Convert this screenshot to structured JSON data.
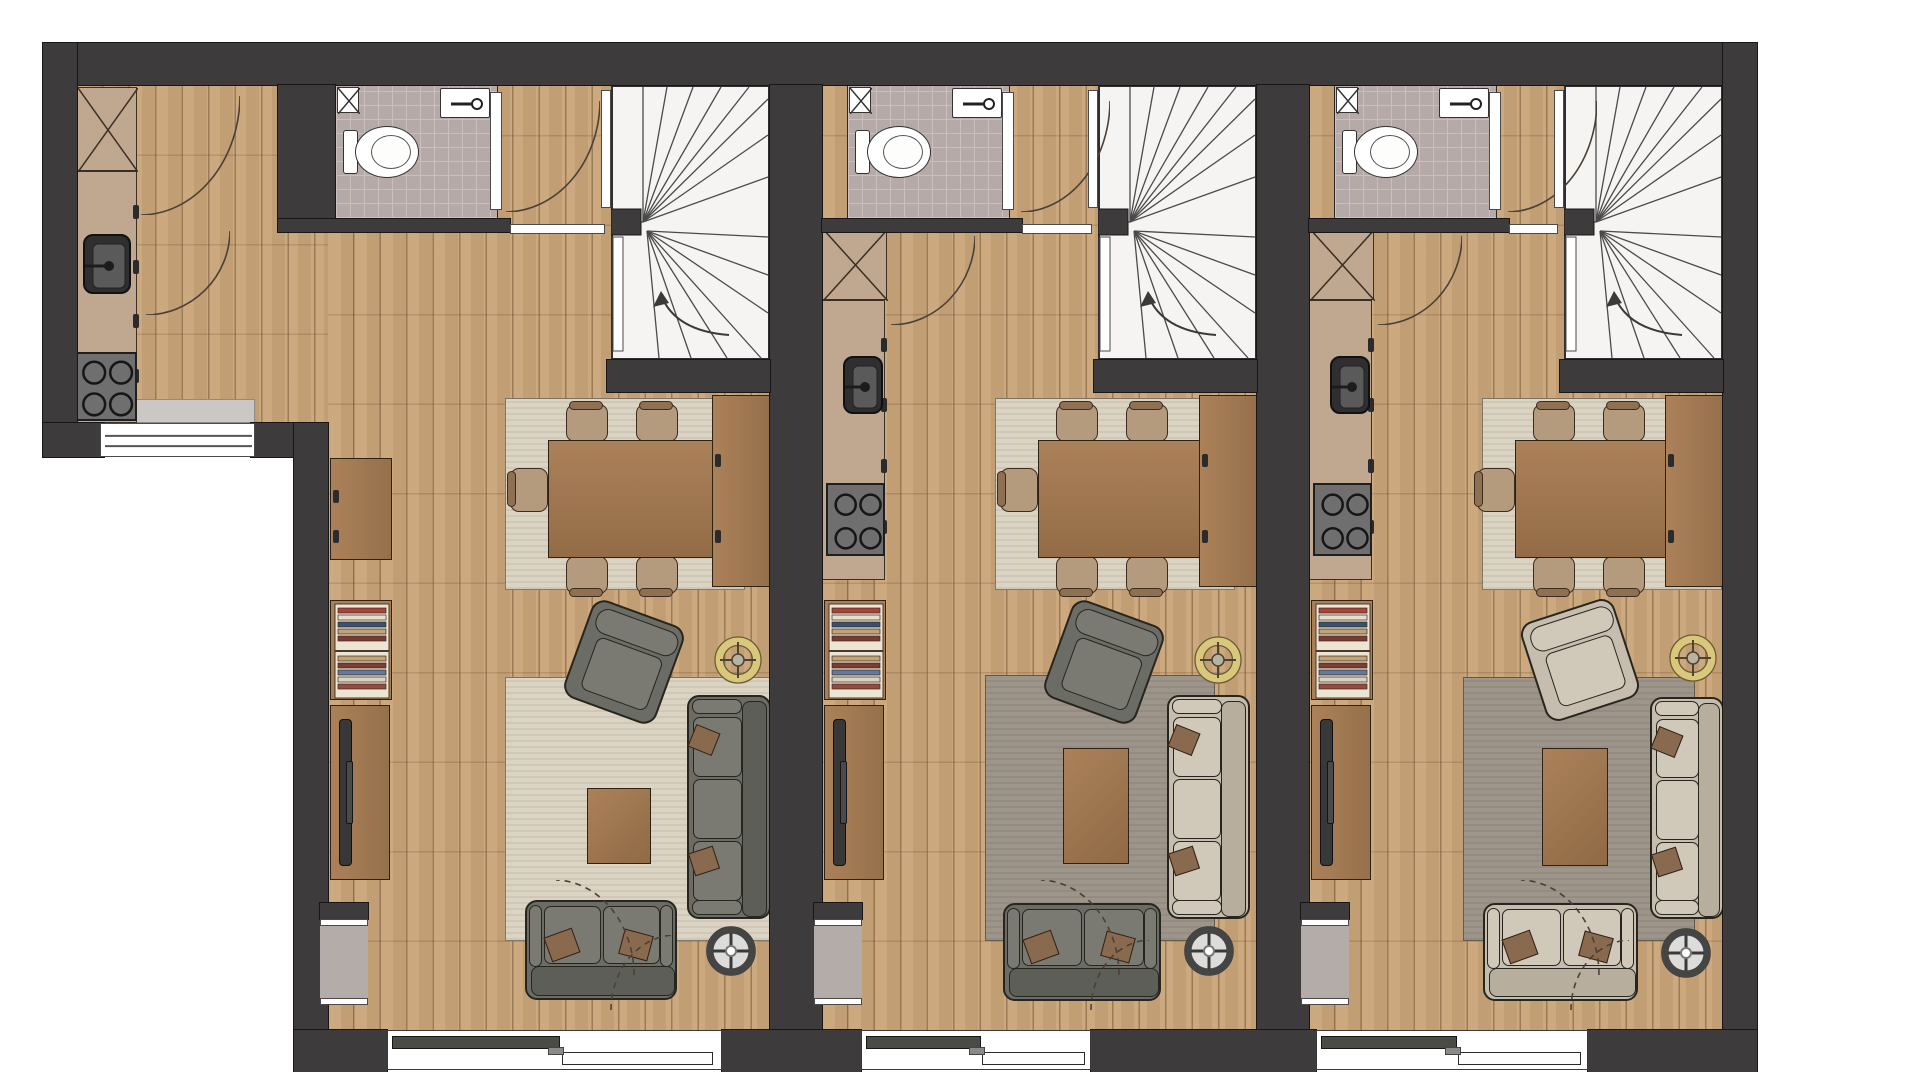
{
  "document": {
    "kind": "architectural floor plan, top view",
    "units_count": 3,
    "rooms_per_unit": [
      "bathroom",
      "winder-staircase",
      "kitchen",
      "dining-area",
      "living-room"
    ],
    "aria_label": "Floor plan of three adjacent apartment units with bathrooms, winder stairs, kitchens, dining and living areas"
  },
  "palette": {
    "wall": "#3e3b3c",
    "wood": "#c9a478",
    "tile": "#b6aaa8",
    "stair_bg": "#f5f4f2",
    "stair_line": "#4a4a4a",
    "rug_cream": "#dcd4c3",
    "rug_gray": "#9d948a",
    "furn_wood": "#a87f58",
    "counter": "#c0a78f",
    "fixture_dark": "#333333",
    "steel": "#6f6f6f",
    "sofa_dark": "#6c6c66",
    "sofa_light": "#c6bdae",
    "pillow_brown": "#8a6a4f",
    "chair_seat": "#b59b7d",
    "chair_back": "#8d7152",
    "lamp_gold": "#d9c77c",
    "glass_dark": "#4b4b45",
    "arc_line": "#4a4038",
    "book_colors": [
      "#a8423a",
      "#e6dfd0",
      "#39506e",
      "#c2a277",
      "#7d3b33",
      "#64789c",
      "#d9d2c2",
      "#974a3e"
    ]
  },
  "stage": {
    "width": 1920,
    "height": 1072
  },
  "items": [
    {
      "t": "wood",
      "n": "unit-1-extension-floor",
      "x": 77,
      "y": 85,
      "w": 251,
      "h": 338
    },
    {
      "t": "wood",
      "n": "unit-1-floor",
      "x": 328,
      "y": 85,
      "w": 442,
      "h": 945
    },
    {
      "t": "wood",
      "n": "unit-2-floor",
      "x": 822,
      "y": 85,
      "w": 435,
      "h": 945
    },
    {
      "t": "wood",
      "n": "unit-3-floor",
      "x": 1309,
      "y": 85,
      "w": 414,
      "h": 945
    },
    {
      "t": "rug",
      "n": "unit-1-dining-rug",
      "x": 505,
      "y": 398,
      "w": 240,
      "h": 192,
      "c": "cream"
    },
    {
      "t": "rug",
      "n": "unit-2-dining-rug",
      "x": 995,
      "y": 398,
      "w": 240,
      "h": 192,
      "c": "cream"
    },
    {
      "t": "rug",
      "n": "unit-3-dining-rug",
      "x": 1482,
      "y": 398,
      "w": 240,
      "h": 192,
      "c": "cream"
    },
    {
      "t": "rug",
      "n": "unit-1-living-rug",
      "x": 505,
      "y": 677,
      "w": 285,
      "h": 264,
      "c": "cream"
    },
    {
      "t": "rug",
      "n": "unit-2-living-rug",
      "x": 985,
      "y": 675,
      "w": 230,
      "h": 266,
      "c": "gray"
    },
    {
      "t": "rug",
      "n": "unit-3-living-rug",
      "x": 1463,
      "y": 677,
      "w": 232,
      "h": 264,
      "c": "gray"
    },
    {
      "t": "bath",
      "n": "unit-1-bathroom",
      "x": 335,
      "y": 85,
      "w": 163,
      "h": 134,
      "doorX": 490
    },
    {
      "t": "bath",
      "n": "unit-2-bathroom",
      "x": 847,
      "y": 85,
      "w": 163,
      "h": 134,
      "doorX": 1002
    },
    {
      "t": "bath",
      "n": "unit-3-bathroom",
      "x": 1334,
      "y": 85,
      "w": 163,
      "h": 134,
      "doorX": 1489
    },
    {
      "t": "stair",
      "n": "unit-1-staircase",
      "x": 611,
      "y": 85,
      "w": 159,
      "h": 275
    },
    {
      "t": "stair",
      "n": "unit-2-staircase",
      "x": 1098,
      "y": 85,
      "w": 159,
      "h": 275
    },
    {
      "t": "stair",
      "n": "unit-3-staircase",
      "x": 1564,
      "y": 85,
      "w": 159,
      "h": 275
    },
    {
      "t": "door",
      "n": "unit-1-entry-door",
      "x": 601,
      "y": 90,
      "w": 10,
      "h": 118
    },
    {
      "t": "door",
      "n": "unit-2-entry-door",
      "x": 1088,
      "y": 90,
      "w": 10,
      "h": 118
    },
    {
      "t": "door",
      "n": "unit-3-entry-door",
      "x": 1554,
      "y": 90,
      "w": 10,
      "h": 118
    },
    {
      "t": "threshold",
      "n": "unit-1-hall-threshold",
      "x": 510,
      "y": 224,
      "w": 95,
      "h": 10
    },
    {
      "t": "threshold",
      "n": "unit-2-hall-threshold",
      "x": 1022,
      "y": 224,
      "w": 70,
      "h": 10
    },
    {
      "t": "threshold",
      "n": "unit-3-hall-threshold",
      "x": 1509,
      "y": 224,
      "w": 49,
      "h": 10
    },
    {
      "t": "crossbox",
      "n": "unit-1-kitchen-tall-cabinet",
      "x": 77,
      "y": 87,
      "w": 60,
      "h": 84
    },
    {
      "t": "counter",
      "n": "unit-1-kitchen-counter",
      "x": 77,
      "y": 171,
      "w": 60,
      "h": 252
    },
    {
      "t": "ksink",
      "n": "unit-1-kitchen-sink",
      "x": 83,
      "y": 234,
      "w": 48,
      "h": 60
    },
    {
      "t": "stove",
      "n": "unit-1-stove",
      "x": 73,
      "y": 352,
      "w": 64,
      "h": 69
    },
    {
      "t": "crossbox",
      "n": "unit-2-kitchen-tall-cabinet",
      "x": 822,
      "y": 228,
      "w": 65,
      "h": 72
    },
    {
      "t": "counter",
      "n": "unit-2-kitchen-counter",
      "x": 822,
      "y": 300,
      "w": 63,
      "h": 280
    },
    {
      "t": "ksink",
      "n": "unit-2-kitchen-sink",
      "x": 843,
      "y": 356,
      "w": 40,
      "h": 58
    },
    {
      "t": "stove",
      "n": "unit-2-stove",
      "x": 826,
      "y": 483,
      "w": 59,
      "h": 73
    },
    {
      "t": "crossbox",
      "n": "unit-3-kitchen-tall-cabinet",
      "x": 1309,
      "y": 228,
      "w": 65,
      "h": 72
    },
    {
      "t": "counter",
      "n": "unit-3-kitchen-counter",
      "x": 1309,
      "y": 300,
      "w": 63,
      "h": 280
    },
    {
      "t": "ksink",
      "n": "unit-3-kitchen-sink",
      "x": 1330,
      "y": 356,
      "w": 40,
      "h": 58
    },
    {
      "t": "stove",
      "n": "unit-3-stove",
      "x": 1313,
      "y": 483,
      "w": 59,
      "h": 73
    },
    {
      "t": "table",
      "n": "unit-1-dining-table",
      "x": 548,
      "y": 440,
      "w": 168,
      "h": 118
    },
    {
      "t": "table",
      "n": "unit-2-dining-table",
      "x": 1038,
      "y": 440,
      "w": 168,
      "h": 118
    },
    {
      "t": "table",
      "n": "unit-3-dining-table",
      "x": 1515,
      "y": 440,
      "w": 168,
      "h": 118
    },
    {
      "t": "chair",
      "n": "unit-1-dining-chair",
      "x": 566,
      "y": 404,
      "w": 42,
      "h": 38,
      "dir": "up"
    },
    {
      "t": "chair",
      "n": "unit-1-dining-chair",
      "x": 636,
      "y": 404,
      "w": 42,
      "h": 38,
      "dir": "up"
    },
    {
      "t": "chair",
      "n": "unit-1-dining-chair",
      "x": 566,
      "y": 556,
      "w": 42,
      "h": 38,
      "dir": "down"
    },
    {
      "t": "chair",
      "n": "unit-1-dining-chair",
      "x": 636,
      "y": 556,
      "w": 42,
      "h": 38,
      "dir": "down"
    },
    {
      "t": "chair",
      "n": "unit-1-dining-chair",
      "x": 510,
      "y": 468,
      "w": 38,
      "h": 44,
      "dir": "left"
    },
    {
      "t": "chair",
      "n": "unit-2-dining-chair",
      "x": 1056,
      "y": 404,
      "w": 42,
      "h": 38,
      "dir": "up"
    },
    {
      "t": "chair",
      "n": "unit-2-dining-chair",
      "x": 1126,
      "y": 404,
      "w": 42,
      "h": 38,
      "dir": "up"
    },
    {
      "t": "chair",
      "n": "unit-2-dining-chair",
      "x": 1056,
      "y": 556,
      "w": 42,
      "h": 38,
      "dir": "down"
    },
    {
      "t": "chair",
      "n": "unit-2-dining-chair",
      "x": 1126,
      "y": 556,
      "w": 42,
      "h": 38,
      "dir": "down"
    },
    {
      "t": "chair",
      "n": "unit-2-dining-chair",
      "x": 1000,
      "y": 468,
      "w": 38,
      "h": 44,
      "dir": "left"
    },
    {
      "t": "chair",
      "n": "unit-3-dining-chair",
      "x": 1533,
      "y": 404,
      "w": 42,
      "h": 38,
      "dir": "up"
    },
    {
      "t": "chair",
      "n": "unit-3-dining-chair",
      "x": 1603,
      "y": 404,
      "w": 42,
      "h": 38,
      "dir": "up"
    },
    {
      "t": "chair",
      "n": "unit-3-dining-chair",
      "x": 1533,
      "y": 556,
      "w": 42,
      "h": 38,
      "dir": "down"
    },
    {
      "t": "chair",
      "n": "unit-3-dining-chair",
      "x": 1603,
      "y": 556,
      "w": 42,
      "h": 38,
      "dir": "down"
    },
    {
      "t": "chair",
      "n": "unit-3-dining-chair",
      "x": 1477,
      "y": 468,
      "w": 38,
      "h": 44,
      "dir": "left"
    },
    {
      "t": "sideboard",
      "n": "unit-1-dining-sideboard",
      "x": 712,
      "y": 395,
      "w": 58,
      "h": 192
    },
    {
      "t": "sideboard",
      "n": "unit-2-dining-sideboard",
      "x": 1199,
      "y": 395,
      "w": 58,
      "h": 192
    },
    {
      "t": "sideboard",
      "n": "unit-3-dining-sideboard",
      "x": 1665,
      "y": 395,
      "w": 58,
      "h": 192
    },
    {
      "t": "sideboard",
      "n": "unit-1-wall-cabinet",
      "x": 330,
      "y": 458,
      "w": 62,
      "h": 102
    },
    {
      "t": "bookshelf",
      "n": "unit-1-bookshelf",
      "x": 330,
      "y": 600,
      "w": 62,
      "h": 100
    },
    {
      "t": "bookshelf",
      "n": "unit-2-bookshelf",
      "x": 824,
      "y": 600,
      "w": 62,
      "h": 100
    },
    {
      "t": "bookshelf",
      "n": "unit-3-bookshelf",
      "x": 1311,
      "y": 600,
      "w": 62,
      "h": 100
    },
    {
      "t": "tvboard",
      "n": "unit-1-tv-board",
      "x": 330,
      "y": 705,
      "w": 60,
      "h": 175
    },
    {
      "t": "tvboard",
      "n": "unit-2-tv-board",
      "x": 824,
      "y": 705,
      "w": 60,
      "h": 175
    },
    {
      "t": "tvboard",
      "n": "unit-3-tv-board",
      "x": 1311,
      "y": 705,
      "w": 60,
      "h": 175
    },
    {
      "t": "armchair",
      "n": "unit-1-armchair",
      "x": 575,
      "y": 610,
      "w": 98,
      "h": 104,
      "rot": 20,
      "c": "dark"
    },
    {
      "t": "armchair",
      "n": "unit-2-armchair",
      "x": 1055,
      "y": 610,
      "w": 98,
      "h": 104,
      "rot": 20,
      "c": "dark"
    },
    {
      "t": "armchair",
      "n": "unit-3-armchair",
      "x": 1531,
      "y": 608,
      "w": 98,
      "h": 104,
      "rot": -18,
      "c": "light"
    },
    {
      "t": "ctable",
      "n": "unit-1-coffee-table",
      "x": 587,
      "y": 788,
      "w": 64,
      "h": 76
    },
    {
      "t": "ctable",
      "n": "unit-2-coffee-table",
      "x": 1063,
      "y": 748,
      "w": 66,
      "h": 116
    },
    {
      "t": "ctable",
      "n": "unit-3-coffee-table",
      "x": 1542,
      "y": 748,
      "w": 66,
      "h": 118
    },
    {
      "t": "sofa",
      "n": "unit-1-sofa",
      "x": 687,
      "y": 695,
      "w": 84,
      "h": 224,
      "c": "dark"
    },
    {
      "t": "sofa",
      "n": "unit-2-sofa",
      "x": 1167,
      "y": 695,
      "w": 83,
      "h": 224,
      "c": "light"
    },
    {
      "t": "sofa",
      "n": "unit-3-sofa",
      "x": 1650,
      "y": 697,
      "w": 74,
      "h": 222,
      "c": "light"
    },
    {
      "t": "loveseat",
      "n": "unit-1-loveseat",
      "x": 525,
      "y": 900,
      "w": 152,
      "h": 100,
      "c": "dark"
    },
    {
      "t": "loveseat",
      "n": "unit-2-loveseat",
      "x": 1003,
      "y": 903,
      "w": 158,
      "h": 98,
      "c": "dark"
    },
    {
      "t": "loveseat",
      "n": "unit-3-loveseat",
      "x": 1483,
      "y": 903,
      "w": 155,
      "h": 98,
      "c": "light"
    },
    {
      "t": "lamp",
      "n": "unit-1-ring-lamp",
      "x": 714,
      "y": 636,
      "w": 48,
      "h": 48
    },
    {
      "t": "lamp",
      "n": "unit-2-ring-lamp",
      "x": 1194,
      "y": 636,
      "w": 48,
      "h": 48
    },
    {
      "t": "lamp",
      "n": "unit-3-ring-lamp",
      "x": 1669,
      "y": 634,
      "w": 48,
      "h": 48
    },
    {
      "t": "speaker",
      "n": "unit-1-round-speaker",
      "x": 705,
      "y": 925,
      "w": 52,
      "h": 52
    },
    {
      "t": "speaker",
      "n": "unit-2-round-speaker",
      "x": 1183,
      "y": 925,
      "w": 52,
      "h": 52
    },
    {
      "t": "speaker",
      "n": "unit-3-round-speaker",
      "x": 1660,
      "y": 927,
      "w": 52,
      "h": 52
    },
    {
      "t": "wall",
      "n": "outer-wall-top",
      "x": 43,
      "y": 43,
      "w": 1714,
      "h": 42
    },
    {
      "t": "wall",
      "n": "outer-wall-right",
      "x": 1723,
      "y": 43,
      "w": 34,
      "h": 1033
    },
    {
      "t": "wall",
      "n": "outer-wall-left",
      "x": 43,
      "y": 43,
      "w": 34,
      "h": 414
    },
    {
      "t": "wall",
      "n": "extension-bottom-wall-left",
      "x": 43,
      "y": 423,
      "w": 61,
      "h": 34
    },
    {
      "t": "wall",
      "n": "extension-bottom-wall-right",
      "x": 251,
      "y": 423,
      "w": 77,
      "h": 34
    },
    {
      "t": "wall",
      "n": "step-wall",
      "x": 294,
      "y": 423,
      "w": 34,
      "h": 653
    },
    {
      "t": "wall",
      "n": "party-wall-1",
      "x": 770,
      "y": 85,
      "w": 52,
      "h": 945
    },
    {
      "t": "wall",
      "n": "party-wall-2",
      "x": 1257,
      "y": 85,
      "w": 52,
      "h": 945
    },
    {
      "t": "wall",
      "n": "bottom-wall-pier-1",
      "x": 294,
      "y": 1030,
      "w": 93,
      "h": 42
    },
    {
      "t": "wall",
      "n": "bottom-wall-pier-2",
      "x": 722,
      "y": 1030,
      "w": 139,
      "h": 42
    },
    {
      "t": "wall",
      "n": "bottom-wall-pier-3",
      "x": 1091,
      "y": 1030,
      "w": 225,
      "h": 42
    },
    {
      "t": "wall",
      "n": "bottom-wall-pier-4",
      "x": 1588,
      "y": 1030,
      "w": 169,
      "h": 42
    },
    {
      "t": "wall",
      "n": "unit-1-bathroom-left-wall",
      "x": 278,
      "y": 85,
      "w": 57,
      "h": 147
    },
    {
      "t": "wall",
      "n": "unit-1-bathroom-bottom-wall",
      "x": 278,
      "y": 219,
      "w": 232,
      "h": 13
    },
    {
      "t": "wall",
      "n": "unit-2-bathroom-bottom-wall",
      "x": 822,
      "y": 219,
      "w": 200,
      "h": 13
    },
    {
      "t": "wall",
      "n": "unit-3-bathroom-bottom-wall",
      "x": 1309,
      "y": 219,
      "w": 200,
      "h": 13
    },
    {
      "t": "wall",
      "n": "unit-1-stair-bottom-wall",
      "x": 607,
      "y": 360,
      "w": 163,
      "h": 32
    },
    {
      "t": "wall",
      "n": "unit-2-stair-bottom-wall",
      "x": 1094,
      "y": 360,
      "w": 163,
      "h": 32
    },
    {
      "t": "wall",
      "n": "unit-3-stair-bottom-wall",
      "x": 1560,
      "y": 360,
      "w": 163,
      "h": 32
    },
    {
      "t": "wall",
      "n": "unit-1-niche-stub",
      "x": 320,
      "y": 903,
      "w": 48,
      "h": 16
    },
    {
      "t": "wall",
      "n": "unit-2-niche-stub",
      "x": 814,
      "y": 903,
      "w": 48,
      "h": 16
    },
    {
      "t": "wall",
      "n": "unit-3-niche-stub",
      "x": 1301,
      "y": 903,
      "w": 48,
      "h": 16
    },
    {
      "t": "niche",
      "n": "unit-1-wall-niche",
      "x": 320,
      "y": 919,
      "w": 48,
      "h": 86
    },
    {
      "t": "niche",
      "n": "unit-2-wall-niche",
      "x": 814,
      "y": 919,
      "w": 48,
      "h": 86
    },
    {
      "t": "niche",
      "n": "unit-3-wall-niche",
      "x": 1301,
      "y": 919,
      "w": 48,
      "h": 86
    },
    {
      "t": "sill",
      "n": "extension-window-sill",
      "x": 100,
      "y": 399,
      "w": 155,
      "h": 24
    },
    {
      "t": "window",
      "n": "extension-window",
      "x": 100,
      "y": 423,
      "w": 155,
      "h": 34
    },
    {
      "t": "slider",
      "n": "unit-1-sliding-door",
      "x": 387,
      "y": 1030,
      "w": 335,
      "h": 40
    },
    {
      "t": "slider",
      "n": "unit-2-sliding-door",
      "x": 861,
      "y": 1030,
      "w": 230,
      "h": 40
    },
    {
      "t": "slider",
      "n": "unit-3-sliding-door",
      "x": 1316,
      "y": 1030,
      "w": 272,
      "h": 40
    },
    {
      "t": "arc",
      "n": "unit-1-door-swing-arc",
      "x": 140,
      "y": 95,
      "w": 100,
      "h": 120,
      "hinge": "tl",
      "dash": false
    },
    {
      "t": "arc",
      "n": "unit-1-door-swing-arc",
      "x": 145,
      "y": 230,
      "w": 85,
      "h": 85,
      "hinge": "tl",
      "dash": false
    },
    {
      "t": "arc",
      "n": "unit-1-bathroom-door-arc",
      "x": 505,
      "y": 100,
      "w": 95,
      "h": 112,
      "hinge": "tl",
      "dash": false
    },
    {
      "t": "arc",
      "n": "unit-1-floor-arc",
      "x": 555,
      "y": 880,
      "w": 80,
      "h": 95,
      "hinge": "bl",
      "dash": true
    },
    {
      "t": "arc",
      "n": "unit-1-floor-arc",
      "x": 610,
      "y": 935,
      "w": 65,
      "h": 75,
      "hinge": "br",
      "dash": true
    },
    {
      "t": "arc",
      "n": "unit-2-kitchen-arc",
      "x": 890,
      "y": 235,
      "w": 85,
      "h": 90,
      "hinge": "tl",
      "dash": false
    },
    {
      "t": "arc",
      "n": "unit-2-bathroom-door-arc",
      "x": 1020,
      "y": 100,
      "w": 90,
      "h": 112,
      "hinge": "tl",
      "dash": false
    },
    {
      "t": "arc",
      "n": "unit-2-floor-arc",
      "x": 1040,
      "y": 880,
      "w": 80,
      "h": 95,
      "hinge": "bl",
      "dash": true
    },
    {
      "t": "arc",
      "n": "unit-2-floor-arc",
      "x": 1090,
      "y": 940,
      "w": 60,
      "h": 70,
      "hinge": "br",
      "dash": true
    },
    {
      "t": "arc",
      "n": "unit-3-kitchen-arc",
      "x": 1377,
      "y": 235,
      "w": 85,
      "h": 90,
      "hinge": "tl",
      "dash": false
    },
    {
      "t": "arc",
      "n": "unit-3-bathroom-door-arc",
      "x": 1507,
      "y": 100,
      "w": 90,
      "h": 112,
      "hinge": "tl",
      "dash": false
    },
    {
      "t": "arc",
      "n": "unit-3-floor-arc",
      "x": 1520,
      "y": 880,
      "w": 80,
      "h": 95,
      "hinge": "bl",
      "dash": true
    },
    {
      "t": "arc",
      "n": "unit-3-floor-arc",
      "x": 1570,
      "y": 940,
      "w": 60,
      "h": 70,
      "hinge": "br",
      "dash": true
    }
  ]
}
